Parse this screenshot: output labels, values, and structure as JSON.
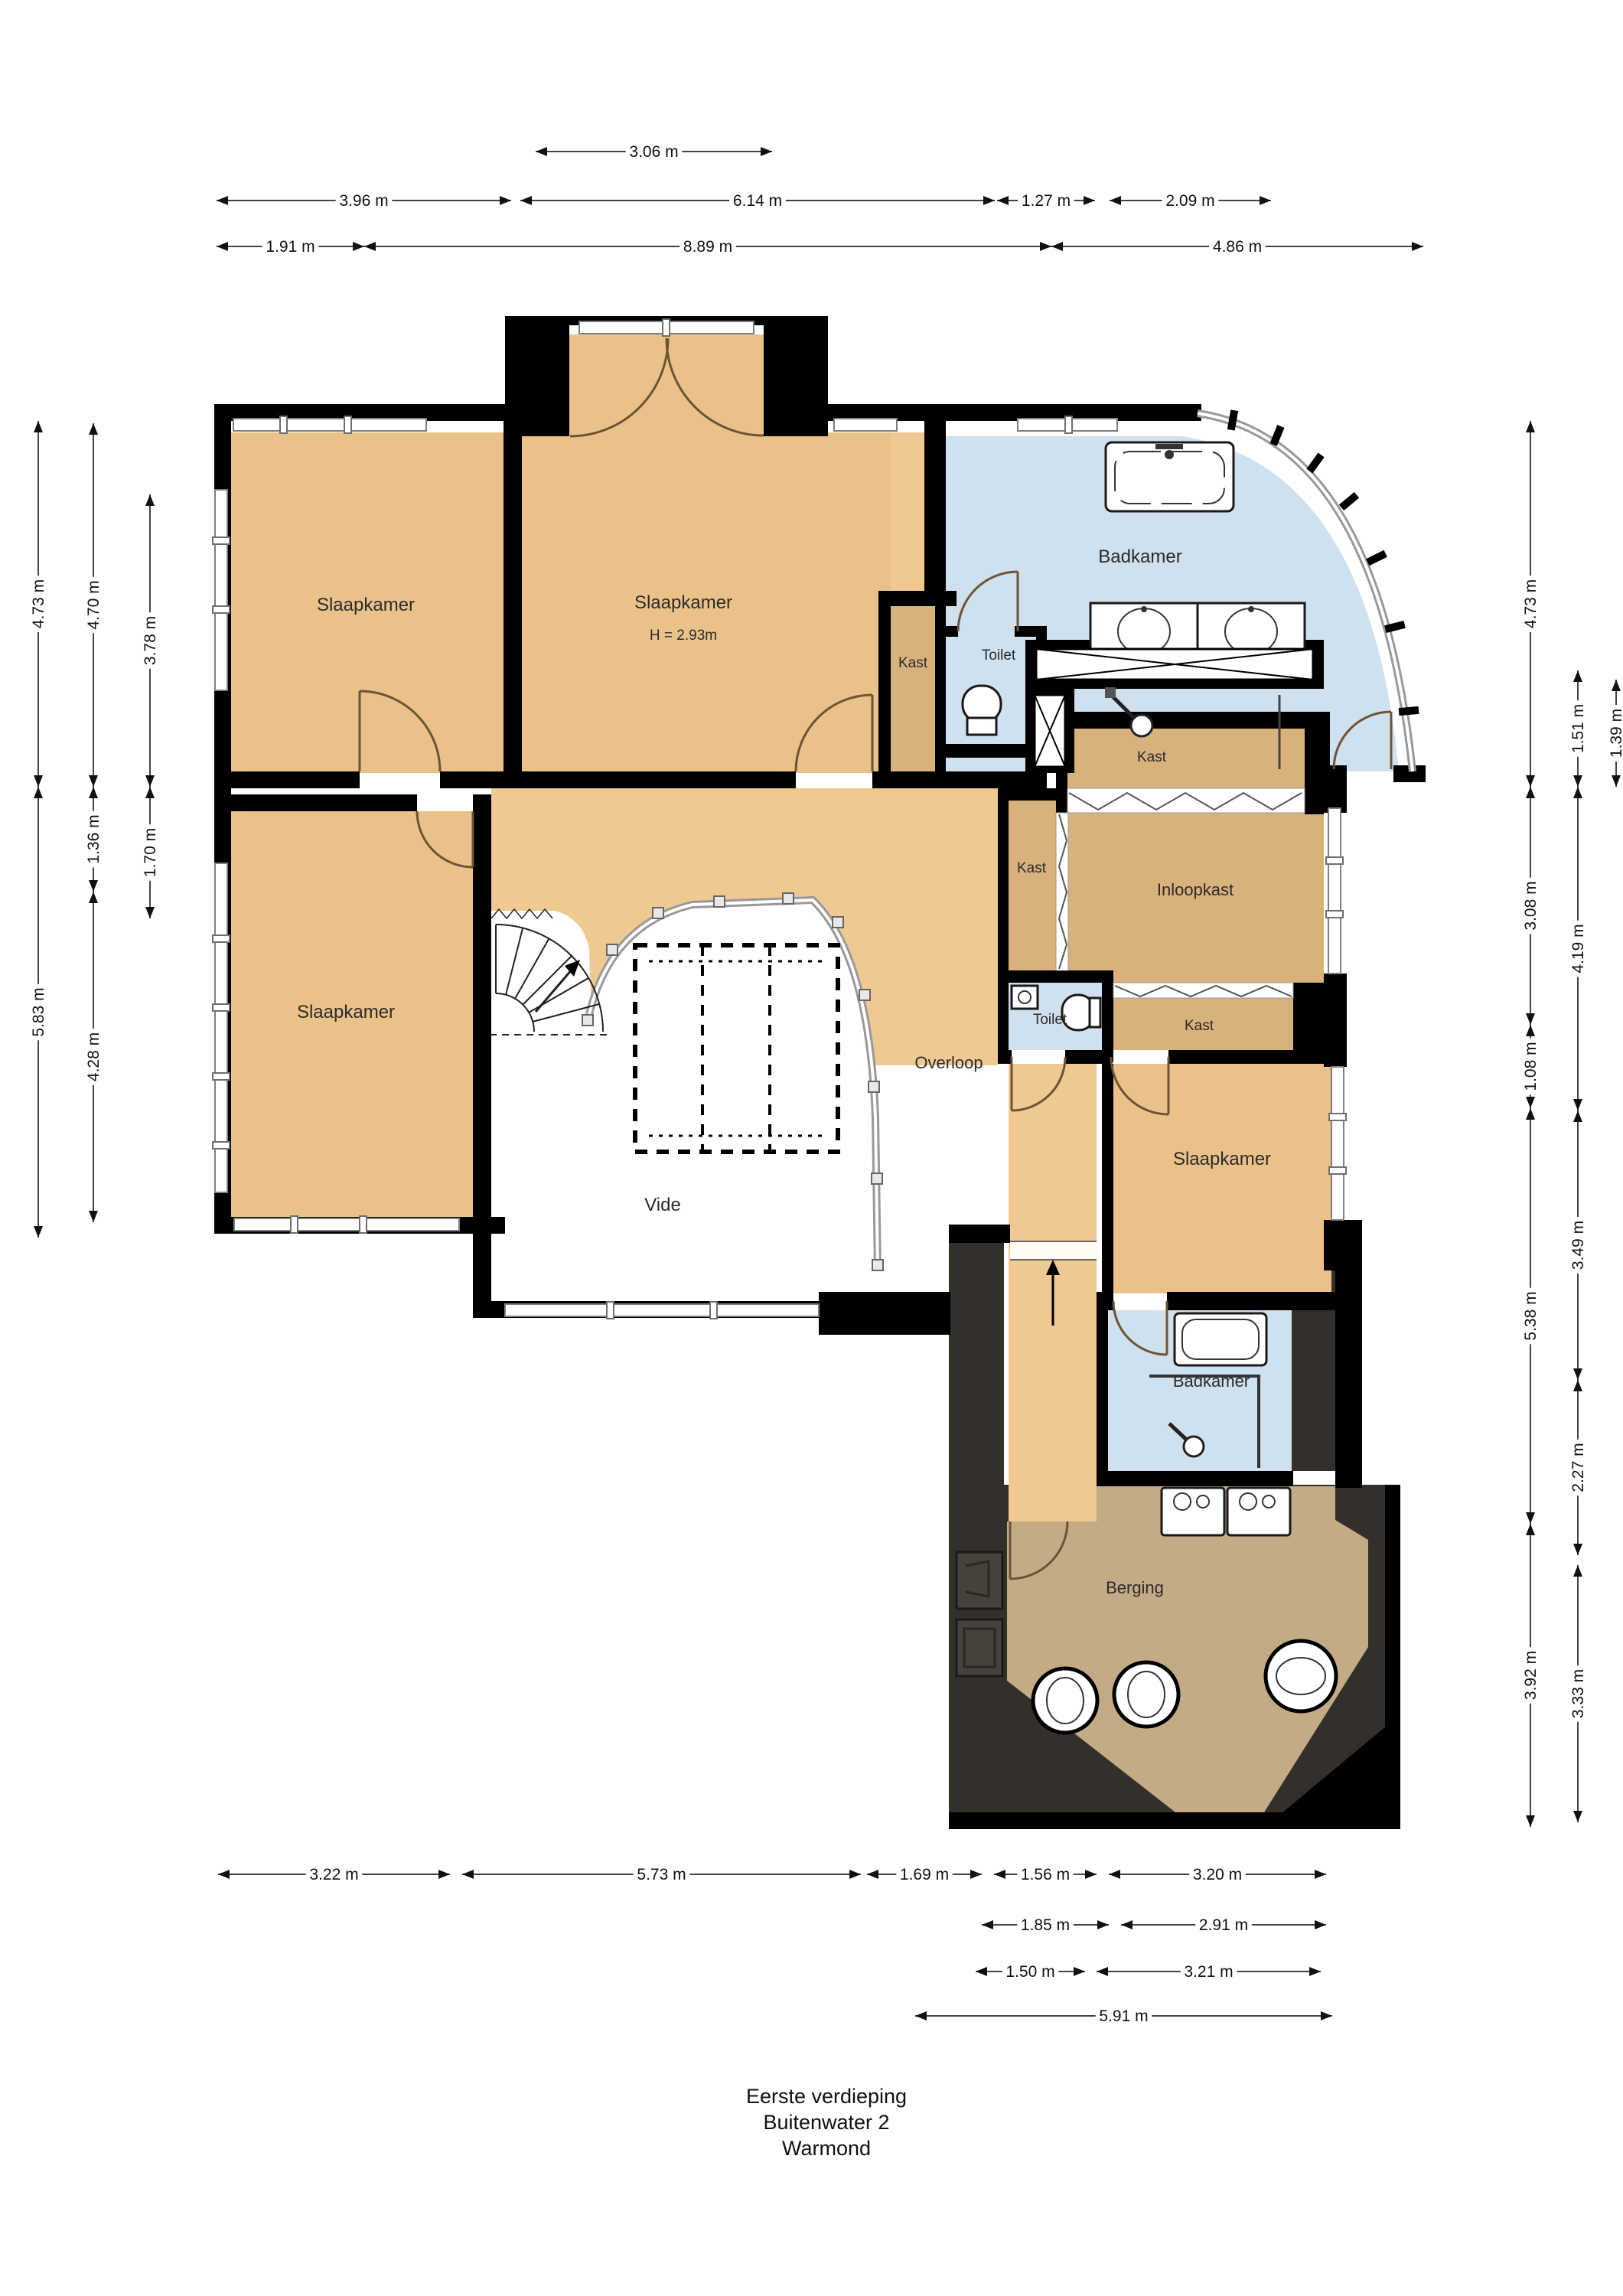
{
  "title": {
    "line1": "Eerste verdieping",
    "line2": "Buitenwater 2",
    "line3": "Warmond"
  },
  "rooms": {
    "slaapkamer_top_left": {
      "label": "Slaapkamer"
    },
    "slaapkamer_top_middle": {
      "label": "Slaapkamer",
      "height_note": "H = 2.93m"
    },
    "kast_top_strip": {
      "label": "Kast"
    },
    "toilet_top": {
      "label": "Toilet"
    },
    "badkamer_top": {
      "label": "Badkamer"
    },
    "slaapkamer_left": {
      "label": "Slaapkamer"
    },
    "vide": {
      "label": "Vide"
    },
    "overloop": {
      "label": "Overloop"
    },
    "kast_above_inloopkast": {
      "label": "Kast"
    },
    "kast_tall": {
      "label": "Kast"
    },
    "inloopkast": {
      "label": "Inloopkast"
    },
    "toilet_middle": {
      "label": "Toilet"
    },
    "kast_below_inloopkast": {
      "label": "Kast"
    },
    "slaapkamer_right": {
      "label": "Slaapkamer"
    },
    "badkamer_lower": {
      "label": "Badkamer"
    },
    "berging": {
      "label": "Berging"
    }
  },
  "dimensions": {
    "top": [
      [
        "3.06 m"
      ],
      [
        "3.96 m",
        "6.14 m",
        "1.27 m",
        "2.09 m"
      ],
      [
        "1.91 m",
        "8.89 m",
        "4.86 m"
      ]
    ],
    "left": [
      [
        "4.73 m",
        "5.83 m"
      ],
      [
        "4.70 m",
        "1.36 m",
        "4.28 m"
      ],
      [
        "3.78 m",
        "1.70 m"
      ]
    ],
    "right": [
      [
        "4.73 m",
        "3.08 m",
        "1.08 m",
        "5.38 m",
        "3.92 m"
      ],
      [
        "1.51 m",
        "4.19 m",
        "3.49 m",
        "2.27 m",
        "3.33 m"
      ],
      [
        "1.39 m"
      ]
    ],
    "bottom": [
      [
        "3.22 m",
        "5.73 m",
        "1.69 m",
        "1.56 m",
        "3.20 m"
      ],
      [
        "1.85 m",
        "2.91 m"
      ],
      [
        "1.50 m",
        "3.21 m"
      ],
      [
        "5.91 m"
      ]
    ]
  },
  "colors": {
    "walls": "#000000",
    "bedroom_floor": "#eac289",
    "hall_floor": "#f0c892",
    "closet_floor": "#d8b17c",
    "bathroom_floor": "#cfe0ee",
    "storage_floor": "#c3ab85",
    "dark_zone": "#332f2a"
  }
}
